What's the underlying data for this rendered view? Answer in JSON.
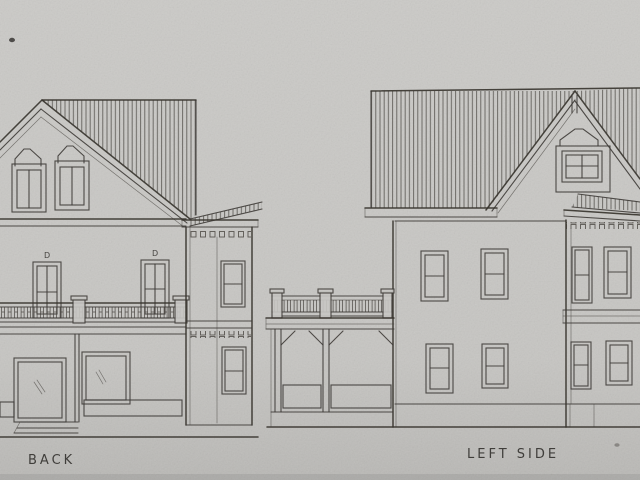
{
  "labels": {
    "back": "BACK",
    "left_side": "LEFT SIDE"
  },
  "annotations": {
    "door_marks": [
      "D",
      "D"
    ]
  },
  "colors": {
    "paper": "#c8c7c4",
    "pencil": "#3e3b37",
    "text": "#2f2d2a"
  }
}
